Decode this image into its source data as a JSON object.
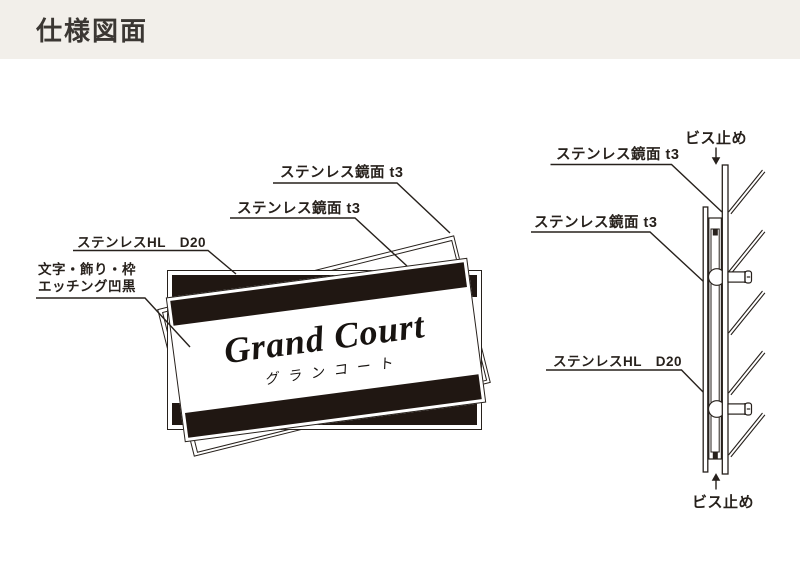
{
  "header": {
    "title": "仕様図面"
  },
  "front_view": {
    "plate": {
      "title": "Grand Court",
      "subtitle": "グランコート"
    },
    "labels": {
      "mirror_top": "ステンレス鏡面 t3",
      "mirror_mid": "ステンレス鏡面 t3",
      "hl": "ステンレスHL　D20",
      "etch_line1": "文字・飾り・枠",
      "etch_line2": "エッチング凹黒"
    }
  },
  "side_view": {
    "labels": {
      "mirror_back": "ステンレス鏡面 t3",
      "mirror_front": "ステンレス鏡面 t3",
      "hl": "ステンレスHL　D20",
      "screw_top": "ビス止め",
      "screw_bottom": "ビス止め"
    }
  },
  "colors": {
    "header_bg": "#f2efea",
    "ink": "#27211c",
    "band_black": "#201712"
  }
}
